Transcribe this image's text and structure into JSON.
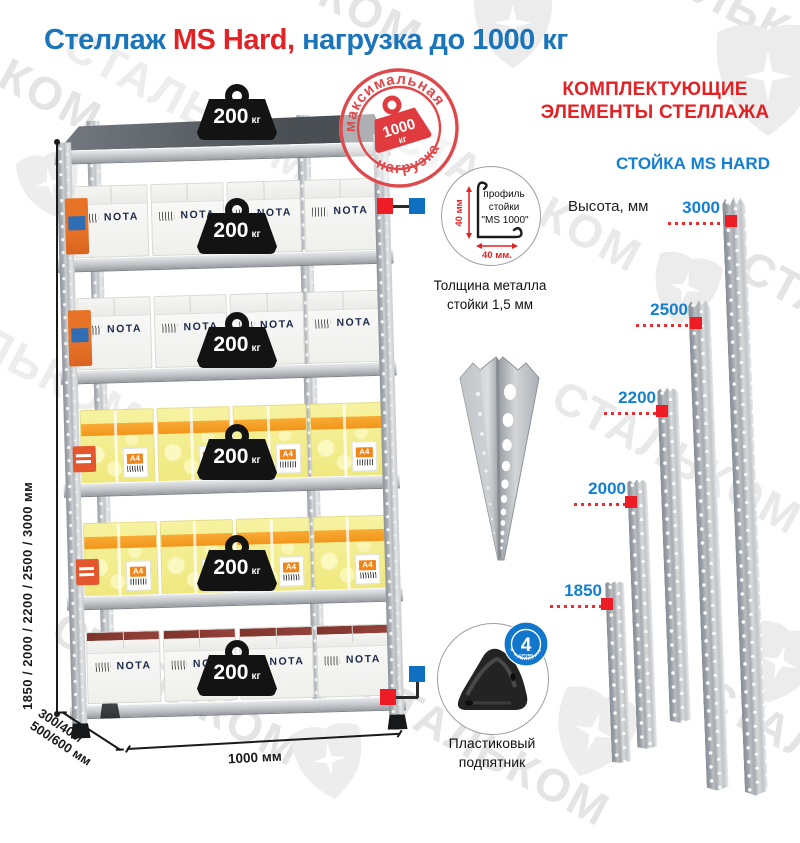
{
  "title": {
    "part1": "Стеллаж ",
    "part2": "MS Hard,",
    "part3": " нагрузка до 1000 кг"
  },
  "watermark": {
    "text": "СТАЛЬКОМ"
  },
  "stamp": {
    "arc_top": "максимальная",
    "arc_bottom": "нагрузка",
    "weight_value": "1000",
    "weight_unit": "кг"
  },
  "rack": {
    "shelf_load": "200",
    "shelf_load_unit": "кг",
    "box_brand": "NOTA",
    "paper_label": "A4",
    "dims": {
      "height": "1850 / 2000 / 2200 / 2500 / 3000 мм",
      "depth_line1": "300/400/",
      "depth_line2": "500/600 мм",
      "width": "1000 мм"
    }
  },
  "profile": {
    "dim_vertical": "40 мм",
    "dim_horizontal": "40 мм.",
    "label_line1": "профиль",
    "label_line2": "стойки",
    "label_line3": "\"MS 1000\"",
    "thickness_line1": "Толщина металла",
    "thickness_line2": "стойки 1,5 мм"
  },
  "components": {
    "header_line1": "КОМПЛЕКТУЮЩИЕ",
    "header_line2": "ЭЛЕМЕНТЫ СТЕЛЛАЖА",
    "post_title": "СТОЙКА MS HARD",
    "height_label": "Высота, мм",
    "posts": [
      {
        "height": "3000"
      },
      {
        "height": "2500"
      },
      {
        "height": "2200"
      },
      {
        "height": "2000"
      },
      {
        "height": "1850"
      }
    ]
  },
  "foot": {
    "badge_number": "4",
    "badge_word": "штуки",
    "badge_arc": "в комплекте",
    "label_line1": "Пластиковый",
    "label_line2": "подпятник"
  },
  "colors": {
    "title_blue": "#1b75bb",
    "accent_red": "#e32226",
    "label_blue": "#1380d2",
    "stamp_red": "#de4a4c",
    "marker_red": "#ee1c24",
    "marker_blue": "#0f6fc0"
  }
}
